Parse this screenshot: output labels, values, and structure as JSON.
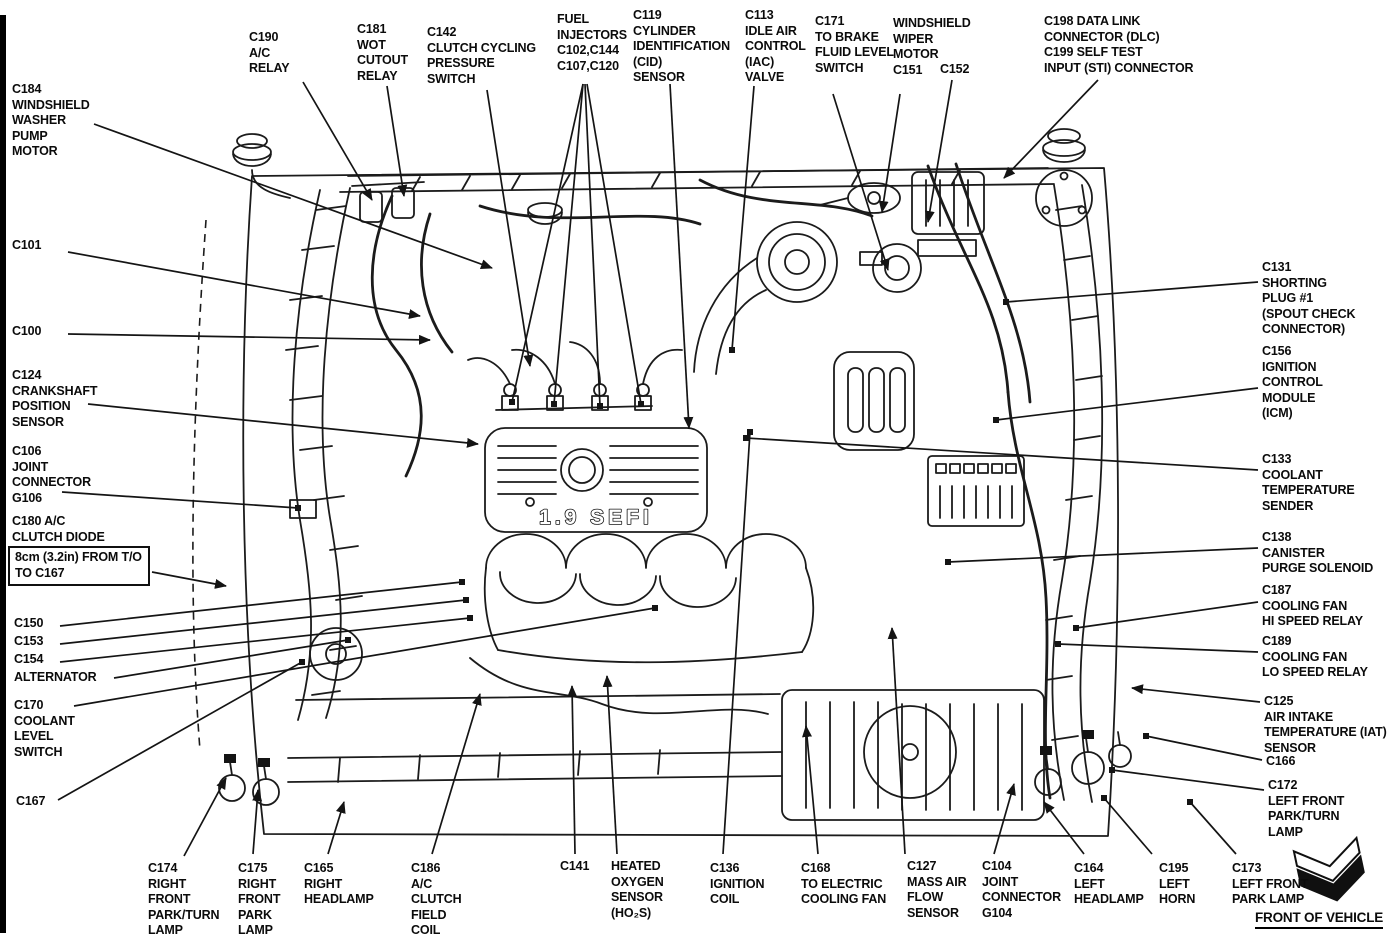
{
  "diagram": {
    "engine_label": "1.9 SEFI",
    "front_of_vehicle_label": "FRONT OF VEHICLE",
    "callouts": [
      {
        "id": "c184",
        "text": "C184\nWINDSHIELD\nWASHER\nPUMP\nMOTOR",
        "x": 12,
        "y": 82,
        "arrow": true,
        "leaders": [
          [
            94,
            124,
            492,
            268
          ]
        ]
      },
      {
        "id": "c190",
        "text": "C190\nA/C\nRELAY",
        "x": 249,
        "y": 30,
        "arrow": true,
        "leaders": [
          [
            303,
            82,
            372,
            200
          ]
        ]
      },
      {
        "id": "c181",
        "text": "C181\nWOT\nCUTOUT\nRELAY",
        "x": 357,
        "y": 22,
        "arrow": true,
        "leaders": [
          [
            387,
            86,
            404,
            196
          ]
        ]
      },
      {
        "id": "c142",
        "text": "C142\nCLUTCH CYCLING\nPRESSURE\nSWITCH",
        "x": 427,
        "y": 25,
        "arrow": true,
        "leaders": [
          [
            487,
            90,
            530,
            366
          ]
        ]
      },
      {
        "id": "fuel-injectors",
        "text": "FUEL\nINJECTORS\nC102,C144\nC107,C120",
        "x": 557,
        "y": 12,
        "arrow": false,
        "leaders": [
          [
            583,
            84,
            512,
            402
          ],
          [
            583,
            84,
            554,
            404
          ],
          [
            585,
            84,
            600,
            406
          ],
          [
            587,
            84,
            641,
            404
          ]
        ]
      },
      {
        "id": "c119",
        "text": "C119\nCYLINDER\nIDENTIFICATION\n(CID)\nSENSOR",
        "x": 633,
        "y": 8,
        "arrow": true,
        "leaders": [
          [
            670,
            84,
            689,
            428
          ]
        ]
      },
      {
        "id": "c113",
        "text": "C113\nIDLE AIR\nCONTROL\n(IAC)\nVALVE",
        "x": 745,
        "y": 8,
        "arrow": false,
        "leaders": [
          [
            754,
            86,
            732,
            350
          ]
        ]
      },
      {
        "id": "c171",
        "text": "C171\nTO BRAKE\nFLUID LEVEL\nSWITCH",
        "x": 815,
        "y": 14,
        "arrow": true,
        "leaders": [
          [
            833,
            94,
            888,
            270
          ]
        ]
      },
      {
        "id": "wiper-motor",
        "text": "WINDSHIELD\nWIPER\nMOTOR\nC151",
        "x": 893,
        "y": 16,
        "arrow": true,
        "leaders": [
          [
            900,
            94,
            882,
            212
          ]
        ]
      },
      {
        "id": "c152",
        "text": "C152",
        "x": 940,
        "y": 62,
        "arrow": true,
        "leaders": [
          [
            952,
            80,
            928,
            222
          ]
        ]
      },
      {
        "id": "c198-c199",
        "text": "C198 DATA LINK\nCONNECTOR (DLC)\nC199 SELF TEST\nINPUT (STI) CONNECTOR",
        "x": 1044,
        "y": 14,
        "arrow": true,
        "leaders": [
          [
            1098,
            80,
            1004,
            178
          ]
        ]
      },
      {
        "id": "c101",
        "text": "C101",
        "x": 12,
        "y": 238,
        "arrow": true,
        "leaders": [
          [
            68,
            252,
            420,
            316
          ]
        ]
      },
      {
        "id": "c100",
        "text": "C100",
        "x": 12,
        "y": 324,
        "arrow": true,
        "leaders": [
          [
            68,
            334,
            430,
            340
          ]
        ]
      },
      {
        "id": "c124",
        "text": "C124\nCRANKSHAFT\nPOSITION\nSENSOR",
        "x": 12,
        "y": 368,
        "arrow": true,
        "leaders": [
          [
            88,
            404,
            478,
            444
          ]
        ]
      },
      {
        "id": "c106",
        "text": "C106\nJOINT\nCONNECTOR\nG106",
        "x": 12,
        "y": 444,
        "arrow": false,
        "leaders": [
          [
            62,
            492,
            298,
            508
          ]
        ]
      },
      {
        "id": "c180",
        "text": "C180 A/C\nCLUTCH DIODE",
        "x": 12,
        "y": 514,
        "arrow": false,
        "leaders": []
      },
      {
        "id": "note-8cm",
        "text": "8cm (3.2in) FROM T/O\nTO C167",
        "x": 8,
        "y": 546,
        "boxed": true,
        "arrow": true,
        "leaders": [
          [
            152,
            572,
            226,
            586
          ]
        ]
      },
      {
        "id": "c150",
        "text": "C150",
        "x": 14,
        "y": 616,
        "arrow": false,
        "leaders": [
          [
            60,
            626,
            462,
            582
          ]
        ]
      },
      {
        "id": "c153",
        "text": "C153",
        "x": 14,
        "y": 634,
        "arrow": false,
        "leaders": [
          [
            60,
            644,
            466,
            600
          ]
        ]
      },
      {
        "id": "c154",
        "text": "C154",
        "x": 14,
        "y": 652,
        "arrow": false,
        "leaders": [
          [
            60,
            662,
            470,
            618
          ]
        ]
      },
      {
        "id": "alternator",
        "text": "ALTERNATOR",
        "x": 14,
        "y": 670,
        "arrow": false,
        "leaders": [
          [
            114,
            678,
            348,
            640
          ]
        ]
      },
      {
        "id": "c170",
        "text": "C170\nCOOLANT\nLEVEL\nSWITCH",
        "x": 14,
        "y": 698,
        "arrow": false,
        "leaders": [
          [
            74,
            706,
            655,
            608
          ]
        ]
      },
      {
        "id": "c167",
        "text": "C167",
        "x": 16,
        "y": 794,
        "arrow": false,
        "leaders": [
          [
            58,
            800,
            302,
            662
          ]
        ]
      },
      {
        "id": "c131",
        "text": "C131\nSHORTING\nPLUG #1\n(SPOUT CHECK\nCONNECTOR)",
        "x": 1262,
        "y": 260,
        "arrow": false,
        "leaders": [
          [
            1258,
            282,
            1006,
            302
          ]
        ]
      },
      {
        "id": "c156",
        "text": "C156\nIGNITION\nCONTROL\nMODULE\n(ICM)",
        "x": 1262,
        "y": 344,
        "arrow": false,
        "leaders": [
          [
            1258,
            388,
            996,
            420
          ]
        ]
      },
      {
        "id": "c133",
        "text": "C133\nCOOLANT\nTEMPERATURE\nSENDER",
        "x": 1262,
        "y": 452,
        "arrow": false,
        "leaders": [
          [
            1258,
            470,
            746,
            438
          ]
        ]
      },
      {
        "id": "c138",
        "text": "C138\nCANISTER\nPURGE SOLENOID",
        "x": 1262,
        "y": 530,
        "arrow": false,
        "leaders": [
          [
            1258,
            548,
            948,
            562
          ]
        ]
      },
      {
        "id": "c187",
        "text": "C187\nCOOLING FAN\nHI SPEED RELAY",
        "x": 1262,
        "y": 583,
        "arrow": false,
        "leaders": [
          [
            1258,
            602,
            1076,
            628
          ]
        ]
      },
      {
        "id": "c189",
        "text": "C189\nCOOLING FAN\nLO SPEED RELAY",
        "x": 1262,
        "y": 634,
        "arrow": false,
        "leaders": [
          [
            1258,
            652,
            1058,
            644
          ]
        ]
      },
      {
        "id": "c125",
        "text": "C125\nAIR INTAKE\nTEMPERATURE (IAT)\nSENSOR",
        "x": 1264,
        "y": 694,
        "arrow": true,
        "leaders": [
          [
            1260,
            702,
            1132,
            688
          ]
        ]
      },
      {
        "id": "c166",
        "text": "C166",
        "x": 1266,
        "y": 754,
        "arrow": false,
        "leaders": [
          [
            1262,
            760,
            1146,
            736
          ]
        ]
      },
      {
        "id": "c172",
        "text": "C172\nLEFT FRONT\nPARK/TURN\nLAMP",
        "x": 1268,
        "y": 778,
        "arrow": false,
        "leaders": [
          [
            1264,
            790,
            1112,
            770
          ]
        ]
      },
      {
        "id": "c174",
        "text": "C174\nRIGHT\nFRONT\nPARK/TURN\nLAMP",
        "x": 148,
        "y": 861,
        "arrow": true,
        "leaders": [
          [
            184,
            856,
            226,
            778
          ]
        ]
      },
      {
        "id": "c175",
        "text": "C175\nRIGHT\nFRONT\nPARK\nLAMP",
        "x": 238,
        "y": 861,
        "arrow": true,
        "leaders": [
          [
            253,
            854,
            258,
            790
          ]
        ]
      },
      {
        "id": "c165",
        "text": "C165\nRIGHT\nHEADLAMP",
        "x": 304,
        "y": 861,
        "arrow": true,
        "leaders": [
          [
            328,
            854,
            344,
            802
          ]
        ]
      },
      {
        "id": "c186",
        "text": "C186\nA/C\nCLUTCH\nFIELD\nCOIL",
        "x": 411,
        "y": 861,
        "arrow": true,
        "leaders": [
          [
            432,
            854,
            480,
            694
          ]
        ]
      },
      {
        "id": "c141",
        "text": "C141",
        "x": 560,
        "y": 859,
        "arrow": true,
        "leaders": [
          [
            575,
            854,
            572,
            686
          ]
        ]
      },
      {
        "id": "ho2s",
        "text": "HEATED\nOXYGEN\nSENSOR\n(HO₂S)",
        "x": 611,
        "y": 859,
        "arrow": true,
        "leaders": [
          [
            617,
            854,
            607,
            676
          ]
        ]
      },
      {
        "id": "c136",
        "text": "C136\nIGNITION\nCOIL",
        "x": 710,
        "y": 861,
        "arrow": false,
        "leaders": [
          [
            723,
            854,
            750,
            432
          ]
        ]
      },
      {
        "id": "c168",
        "text": "C168\nTO ELECTRIC\nCOOLING FAN",
        "x": 801,
        "y": 861,
        "arrow": true,
        "leaders": [
          [
            818,
            854,
            806,
            726
          ]
        ]
      },
      {
        "id": "c127",
        "text": "C127\nMASS AIR\nFLOW\nSENSOR",
        "x": 907,
        "y": 859,
        "arrow": true,
        "leaders": [
          [
            905,
            854,
            892,
            628
          ]
        ]
      },
      {
        "id": "c104",
        "text": "C104\nJOINT\nCONNECTOR\nG104",
        "x": 982,
        "y": 859,
        "arrow": true,
        "leaders": [
          [
            994,
            854,
            1014,
            784
          ]
        ]
      },
      {
        "id": "c164",
        "text": "C164\nLEFT\nHEADLAMP",
        "x": 1074,
        "y": 861,
        "arrow": true,
        "leaders": [
          [
            1084,
            854,
            1044,
            802
          ]
        ]
      },
      {
        "id": "c195",
        "text": "C195\nLEFT\nHORN",
        "x": 1159,
        "y": 861,
        "arrow": false,
        "leaders": [
          [
            1152,
            854,
            1104,
            798
          ]
        ]
      },
      {
        "id": "c173",
        "text": "C173\nLEFT FRONT\nPARK LAMP",
        "x": 1232,
        "y": 861,
        "arrow": false,
        "leaders": [
          [
            1236,
            854,
            1190,
            802
          ]
        ]
      }
    ]
  }
}
